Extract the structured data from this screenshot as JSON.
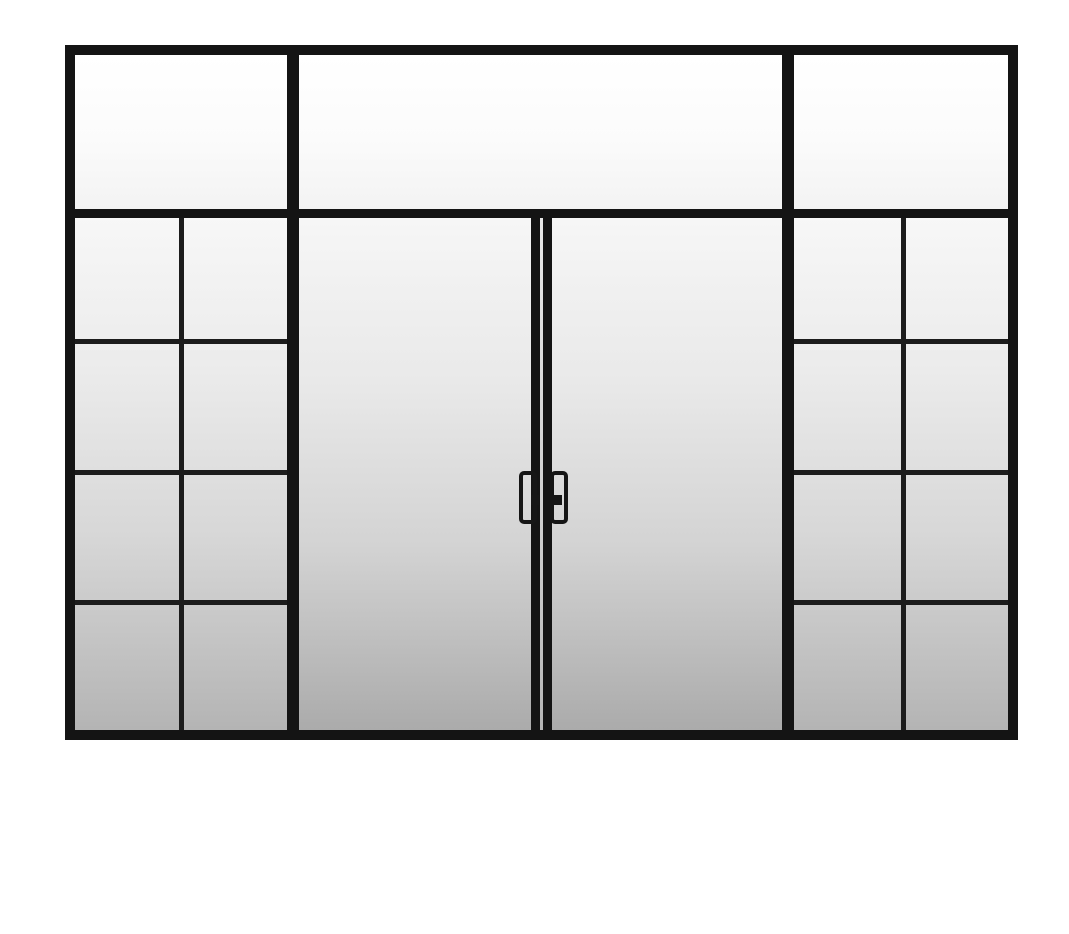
{
  "scene": {
    "type": "product-image",
    "subject": "Black steel-framed glass double door unit with gridded sidelights and transom windows",
    "background_color": "#ffffff"
  },
  "palette": {
    "frame_black": "#141414",
    "muntin_black": "#1c1c1c",
    "glass_highlight": "#f7f7f7",
    "glass_shadow": "#ababab",
    "transom_white": "#ffffff",
    "meeting_gap_gray": "#c9c9c9"
  },
  "structure": {
    "transom": {
      "pane_count": 3,
      "panes": [
        "left",
        "center-wide",
        "right"
      ]
    },
    "sidelights": {
      "count": 2,
      "grid_rows": 4,
      "grid_columns": 2,
      "panes_each": 8
    },
    "doors": {
      "count": 2,
      "glazing": "single full-height pane each",
      "meeting_stiles": 2
    },
    "handles": {
      "count": 2,
      "style": "vertical-pull-with-thumb-latch",
      "color": "#161616"
    }
  }
}
